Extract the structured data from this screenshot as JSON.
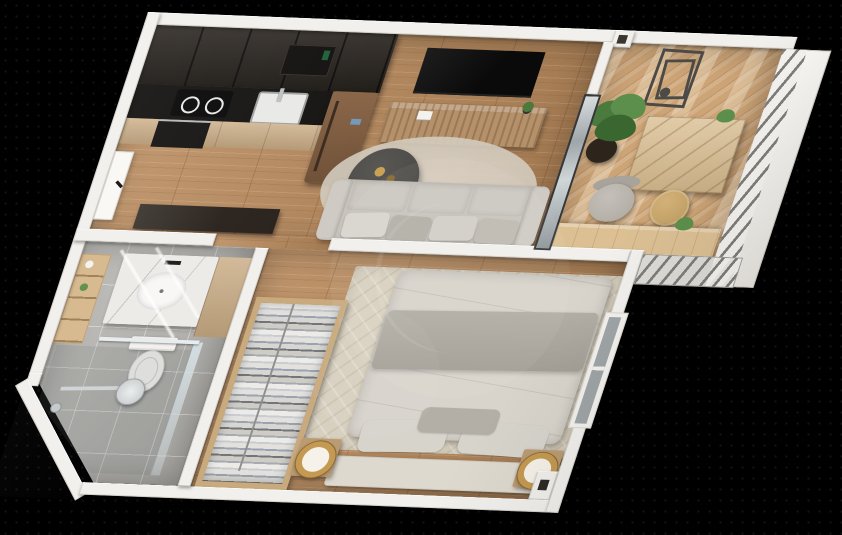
{
  "scene": {
    "title": "3D apartment floor plan render, top-down cutaway view on black background",
    "background": "#000000",
    "watermark": {
      "visible": true,
      "shape": "circle-crescent",
      "color": "rgba(255,255,255,0.08)"
    },
    "palette": {
      "wall": "#f2f0ec",
      "wood_floor": "#b98a5c",
      "deck_floor": "#cda476",
      "tile_floor": "#b6b5b1",
      "dark_cabinet": "#2c2722",
      "black_counter": "#171614",
      "light_wood": "#c9ab83",
      "fridge_bronze": "#7d5b40",
      "sofa_gray": "#c8c4bd",
      "bed_linen": "#d8d4cc",
      "throw_gray": "#a9a59c",
      "lamp_gold": "#c49a52",
      "plant_green": "#4a7a3e",
      "glass": "#cdd4d6",
      "art_frame": "#4b4a47"
    },
    "rooms": [
      {
        "name": "kitchen",
        "furniture": [
          "tall dark cabinets",
          "microwave",
          "black counter",
          "induction hob",
          "sink",
          "oven",
          "bronze refrigerator",
          "light wood base units"
        ]
      },
      {
        "name": "living room",
        "furniture": [
          "wall TV",
          "wood media console",
          "round coffee table with two cups and magazine",
          "gray sofa with cushions",
          "round rug"
        ]
      },
      {
        "name": "hallway",
        "furniture": [
          "entry door with black handle",
          "dark console desk"
        ]
      },
      {
        "name": "balcony",
        "furniture": [
          "geometric wall art",
          "potted plant",
          "wood storage chest",
          "armchair",
          "pouf",
          "deck counter with plant",
          "metal slat railing",
          "white glass panels"
        ]
      },
      {
        "name": "bedroom",
        "furniture": [
          "double bed",
          "gray throw",
          "pillows",
          "headboard",
          "two nightstands",
          "round gold lamps",
          "open wardrobe with hanging clothes",
          "area rug",
          "window",
          "corner shaft"
        ]
      },
      {
        "name": "bathroom",
        "furniture": [
          "marble vanity with basin",
          "wood cabinet",
          "toilet",
          "walk-in shower",
          "glass screen",
          "shower head",
          "mixer knobs",
          "towel shelf",
          "led light strips"
        ]
      }
    ]
  }
}
